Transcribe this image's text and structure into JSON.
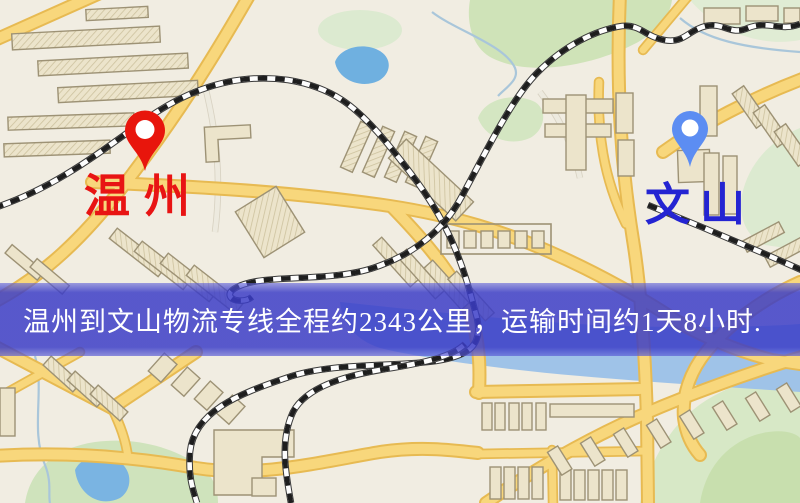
{
  "map": {
    "origin": {
      "label": "温州",
      "pin_color": "#e8150c",
      "label_color": "#e81414"
    },
    "destination": {
      "label": "文山",
      "pin_color": "#5c8df2",
      "label_color": "#2424d2"
    }
  },
  "banner": {
    "text": "温州到文山物流专线全程约2343公里，运输时间约1天8小时.",
    "background_color": "#3a3cc7",
    "text_color": "#ffffff"
  },
  "palette": {
    "map_background": "#f1ede2",
    "road_fill": "#f8d77c",
    "road_casing": "#e7ba52",
    "building_fill": "#ece4cb",
    "park_green": "#d6e7c3",
    "water_blue": "#85b7e2",
    "railway_dark": "#1e1e1e"
  }
}
